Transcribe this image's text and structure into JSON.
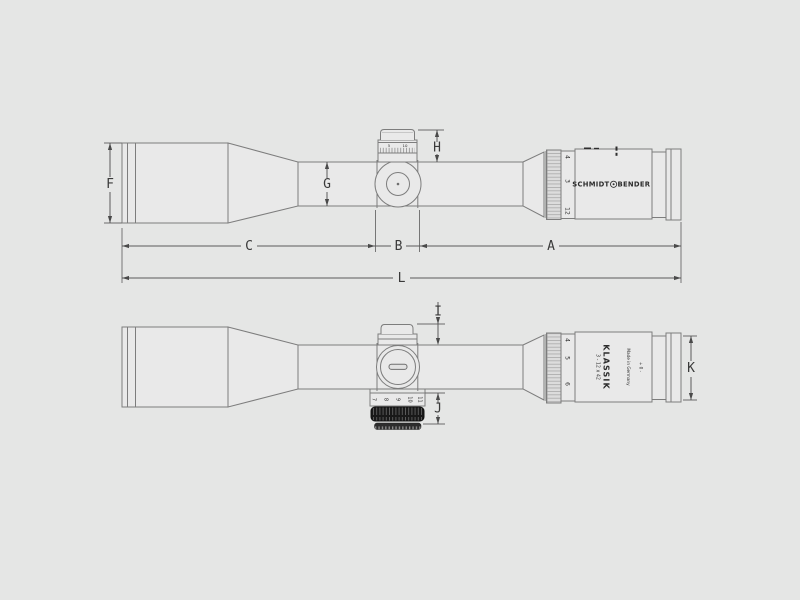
{
  "drawing": {
    "type": "technical-dimension-drawing",
    "subject": "riflescope two-view drawing",
    "colors": {
      "background": "#e5e6e5",
      "outline": "#7d7d7d",
      "dimension_lines": "#5a5a5a",
      "text": "#3a3a3a",
      "dark_knurl_band": "#191919"
    }
  },
  "top_view": {
    "dim_labels": {
      "F": "F",
      "G": "G",
      "H": "H",
      "C": "C",
      "B": "B",
      "A": "A",
      "L": "L"
    },
    "turret_scale_numbers": [
      "5",
      "10"
    ],
    "mag_ring_numbers": [
      "4",
      "3",
      "12"
    ],
    "brand_left": "SCHMIDT",
    "brand_right": "BENDER"
  },
  "bottom_view": {
    "dim_labels": {
      "I": "I",
      "J": "J",
      "K": "K"
    },
    "mag_ring_numbers": [
      "4",
      "5",
      "6"
    ],
    "model_magnification": "3 - 12 x 42",
    "model_name": "KLASSIK",
    "origin_label": "Made in Germany",
    "zero_adjust_label": "+ 0 -",
    "distance_ring_numbers": [
      "7",
      "8",
      "9",
      "10",
      "11"
    ]
  }
}
